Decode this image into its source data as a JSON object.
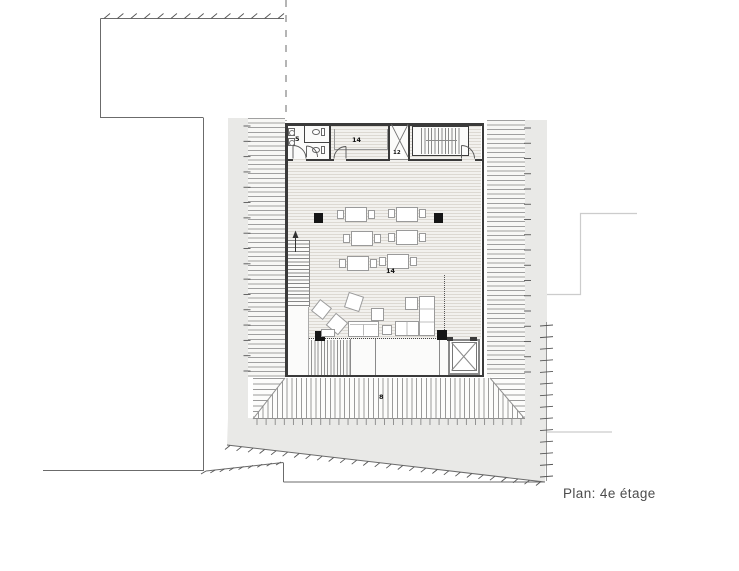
{
  "title": "Plan: 4e étage",
  "labels": {
    "wc_room": "5",
    "top_room": "14",
    "elevator": "12",
    "hall": "14",
    "canopy": "8"
  },
  "colors": {
    "wall": "#3a3a3a",
    "site_wash": "#e9e9e7",
    "hatch_line": "#9a9a9a",
    "floor": "#f2f1ee",
    "column": "#151515",
    "boundary_line": "#6b6b6b",
    "neighbor_outline": "#cccccc",
    "title_text": "#4c4c4c"
  }
}
